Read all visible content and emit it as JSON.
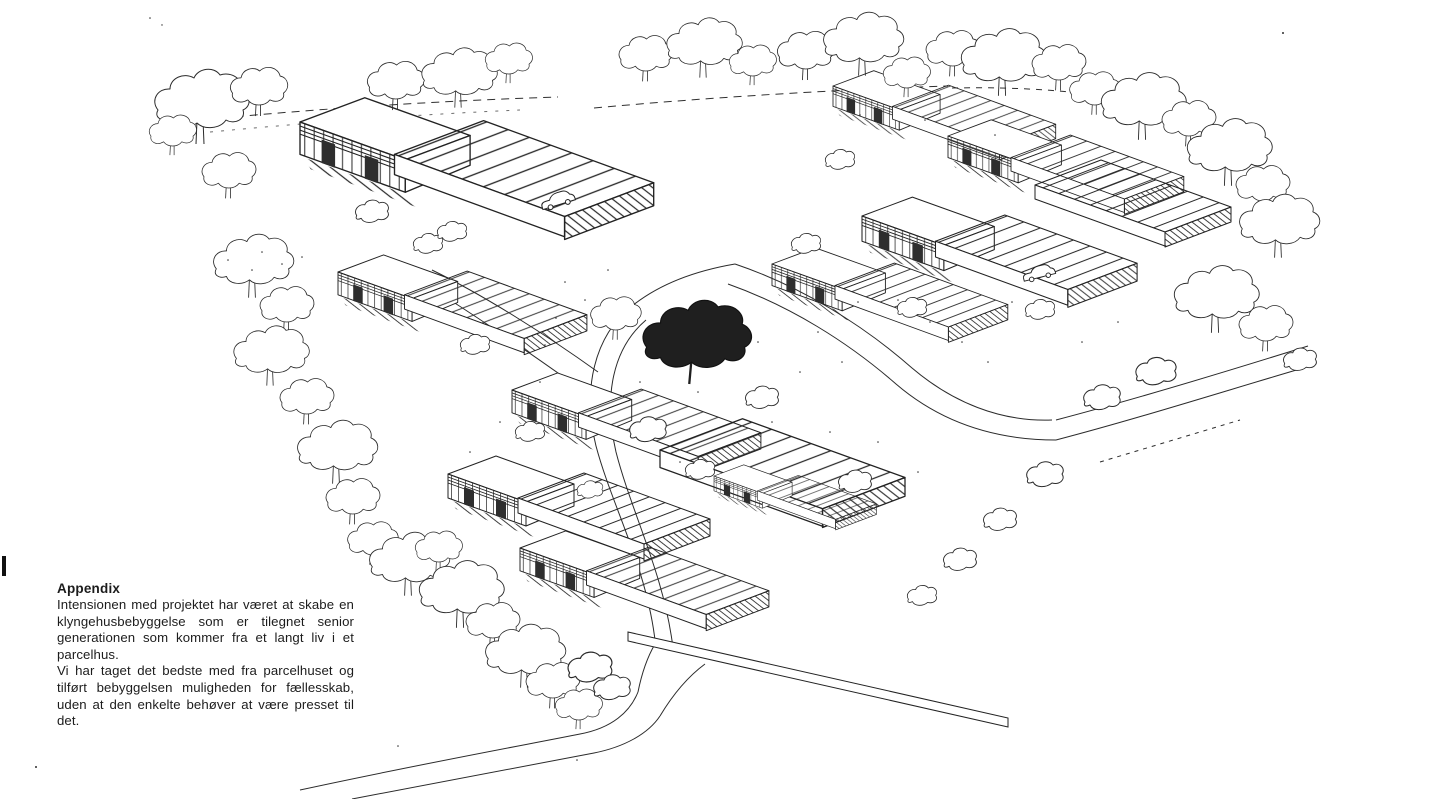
{
  "appendix": {
    "title": "Appendix",
    "paragraphs": [
      "Intensionen med projektet har været at skabe en klyngehusbebyggelse som er tilegnet senior generationen som kommer fra et langt liv i et parcelhus.",
      "Vi har taget det bedste med fra parcelhuset og tilført bebyggelsen muligheden for fællesskab, uden at den enkelte behøver at være presset til det."
    ]
  },
  "drawing": {
    "description": "Hand-drawn bird's-eye perspective sketch of a cluster-house (klyngehus) development: pairs of low houses with hatched mono-pitch roofs arranged in groups, surrounded by trees, with an internal loop road, two parked cars, one solid dark tree in the centre and an entrance road junction at the bottom.",
    "ink_color": "#2a2a2a",
    "background_color": "#ffffff"
  }
}
